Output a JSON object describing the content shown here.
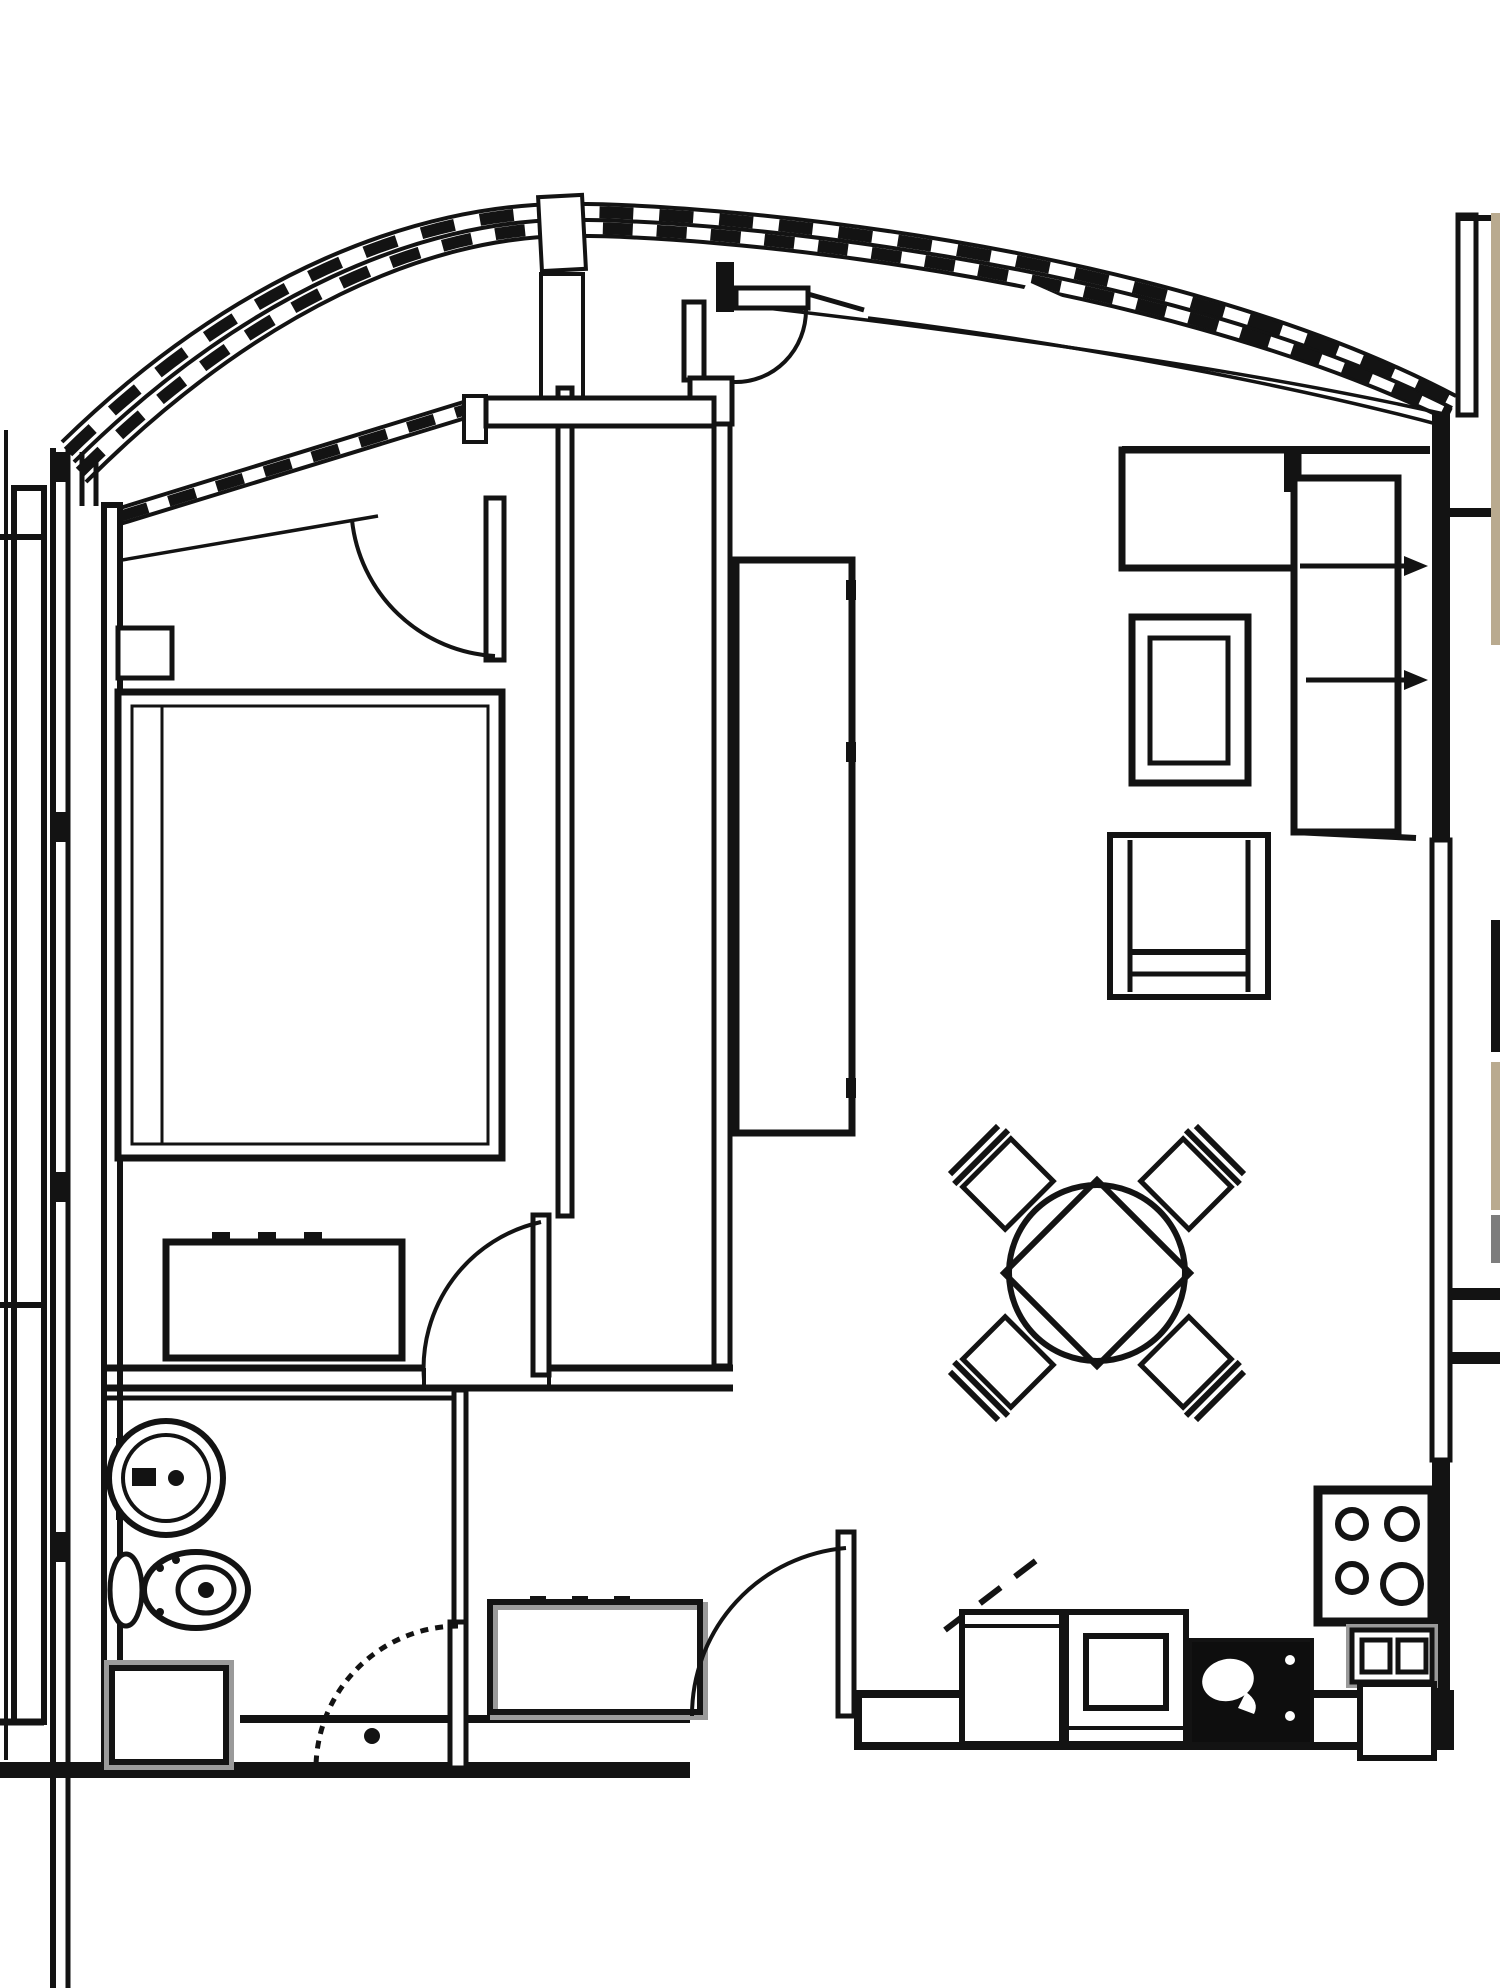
{
  "document": {
    "type": "floor-plan-drawing",
    "title": "One-bedroom apartment floor plan",
    "canvas": {
      "width_px": 1500,
      "height_px": 1988,
      "background": "#ffffff"
    },
    "colors": {
      "line": "#131313",
      "shadow_gray": "#9a9a9a",
      "neighbor_wall_tan": "#b9aa8f",
      "neighbor_wall_gray": "#7d7d7d",
      "neighbor_wall_black": "#131313"
    }
  },
  "rooms": {
    "balcony": {
      "label": "Curved glazed balcony along top and left edge",
      "features": [
        "multi-line curved window band with mullion dashes",
        "white break post near apex",
        "white slash break on right curve",
        "parapet bars on left edge"
      ]
    },
    "bedroom": {
      "label": "Bedroom (top left)",
      "furniture": [
        "double bed with mattress and pillow line",
        "nightstand",
        "dresser with sliding-door ticks"
      ]
    },
    "living_room": {
      "label": "Living room (right)",
      "furniture": [
        "L-shaped sofa with two pull-out arrows",
        "coffee table",
        "armchair",
        "round dining table with diamond overlay and four diagonal chairs",
        "tall cabinet with three door handles"
      ]
    },
    "bathroom": {
      "label": "Bathroom (bottom left)",
      "furniture": [
        "round wash basin",
        "toilet with tank",
        "washing machine"
      ]
    },
    "hallway": {
      "label": "Entry hall (bottom center)",
      "furniture": [
        "built-in closet with tick marks"
      ]
    },
    "kitchen": {
      "label": "Kitchen (bottom right)",
      "furniture": [
        "counter unit",
        "oven with inner square",
        "dark sink unit",
        "4-burner cooktop",
        "two-compartment unit",
        "fridge/cabinet",
        "dashed wall-cabinet line"
      ]
    }
  },
  "doors": [
    {
      "id": "bedroom-balcony-door",
      "label": "Balcony door into bedroom, quarter-circle swing"
    },
    {
      "id": "living-balcony-door",
      "label": "Balcony door into living room, quarter-circle swing with black hinge post"
    },
    {
      "id": "bedroom-door",
      "label": "Bedroom door opening into bedroom at bottom-right corner"
    },
    {
      "id": "bathroom-door",
      "label": "Bathroom door, dashed quarter-circle swing with handle dot"
    },
    {
      "id": "entry-door",
      "label": "Apartment entry door in bottom wall, swings into hall"
    }
  ],
  "annotations": {
    "sofa_arrows": {
      "label": "Two right-pointing pull-out arrows from sofa to right wall",
      "count": 2
    },
    "neighbor_slivers": {
      "label": "Adjacent unit wall fragments along right edge",
      "count": 4
    }
  }
}
